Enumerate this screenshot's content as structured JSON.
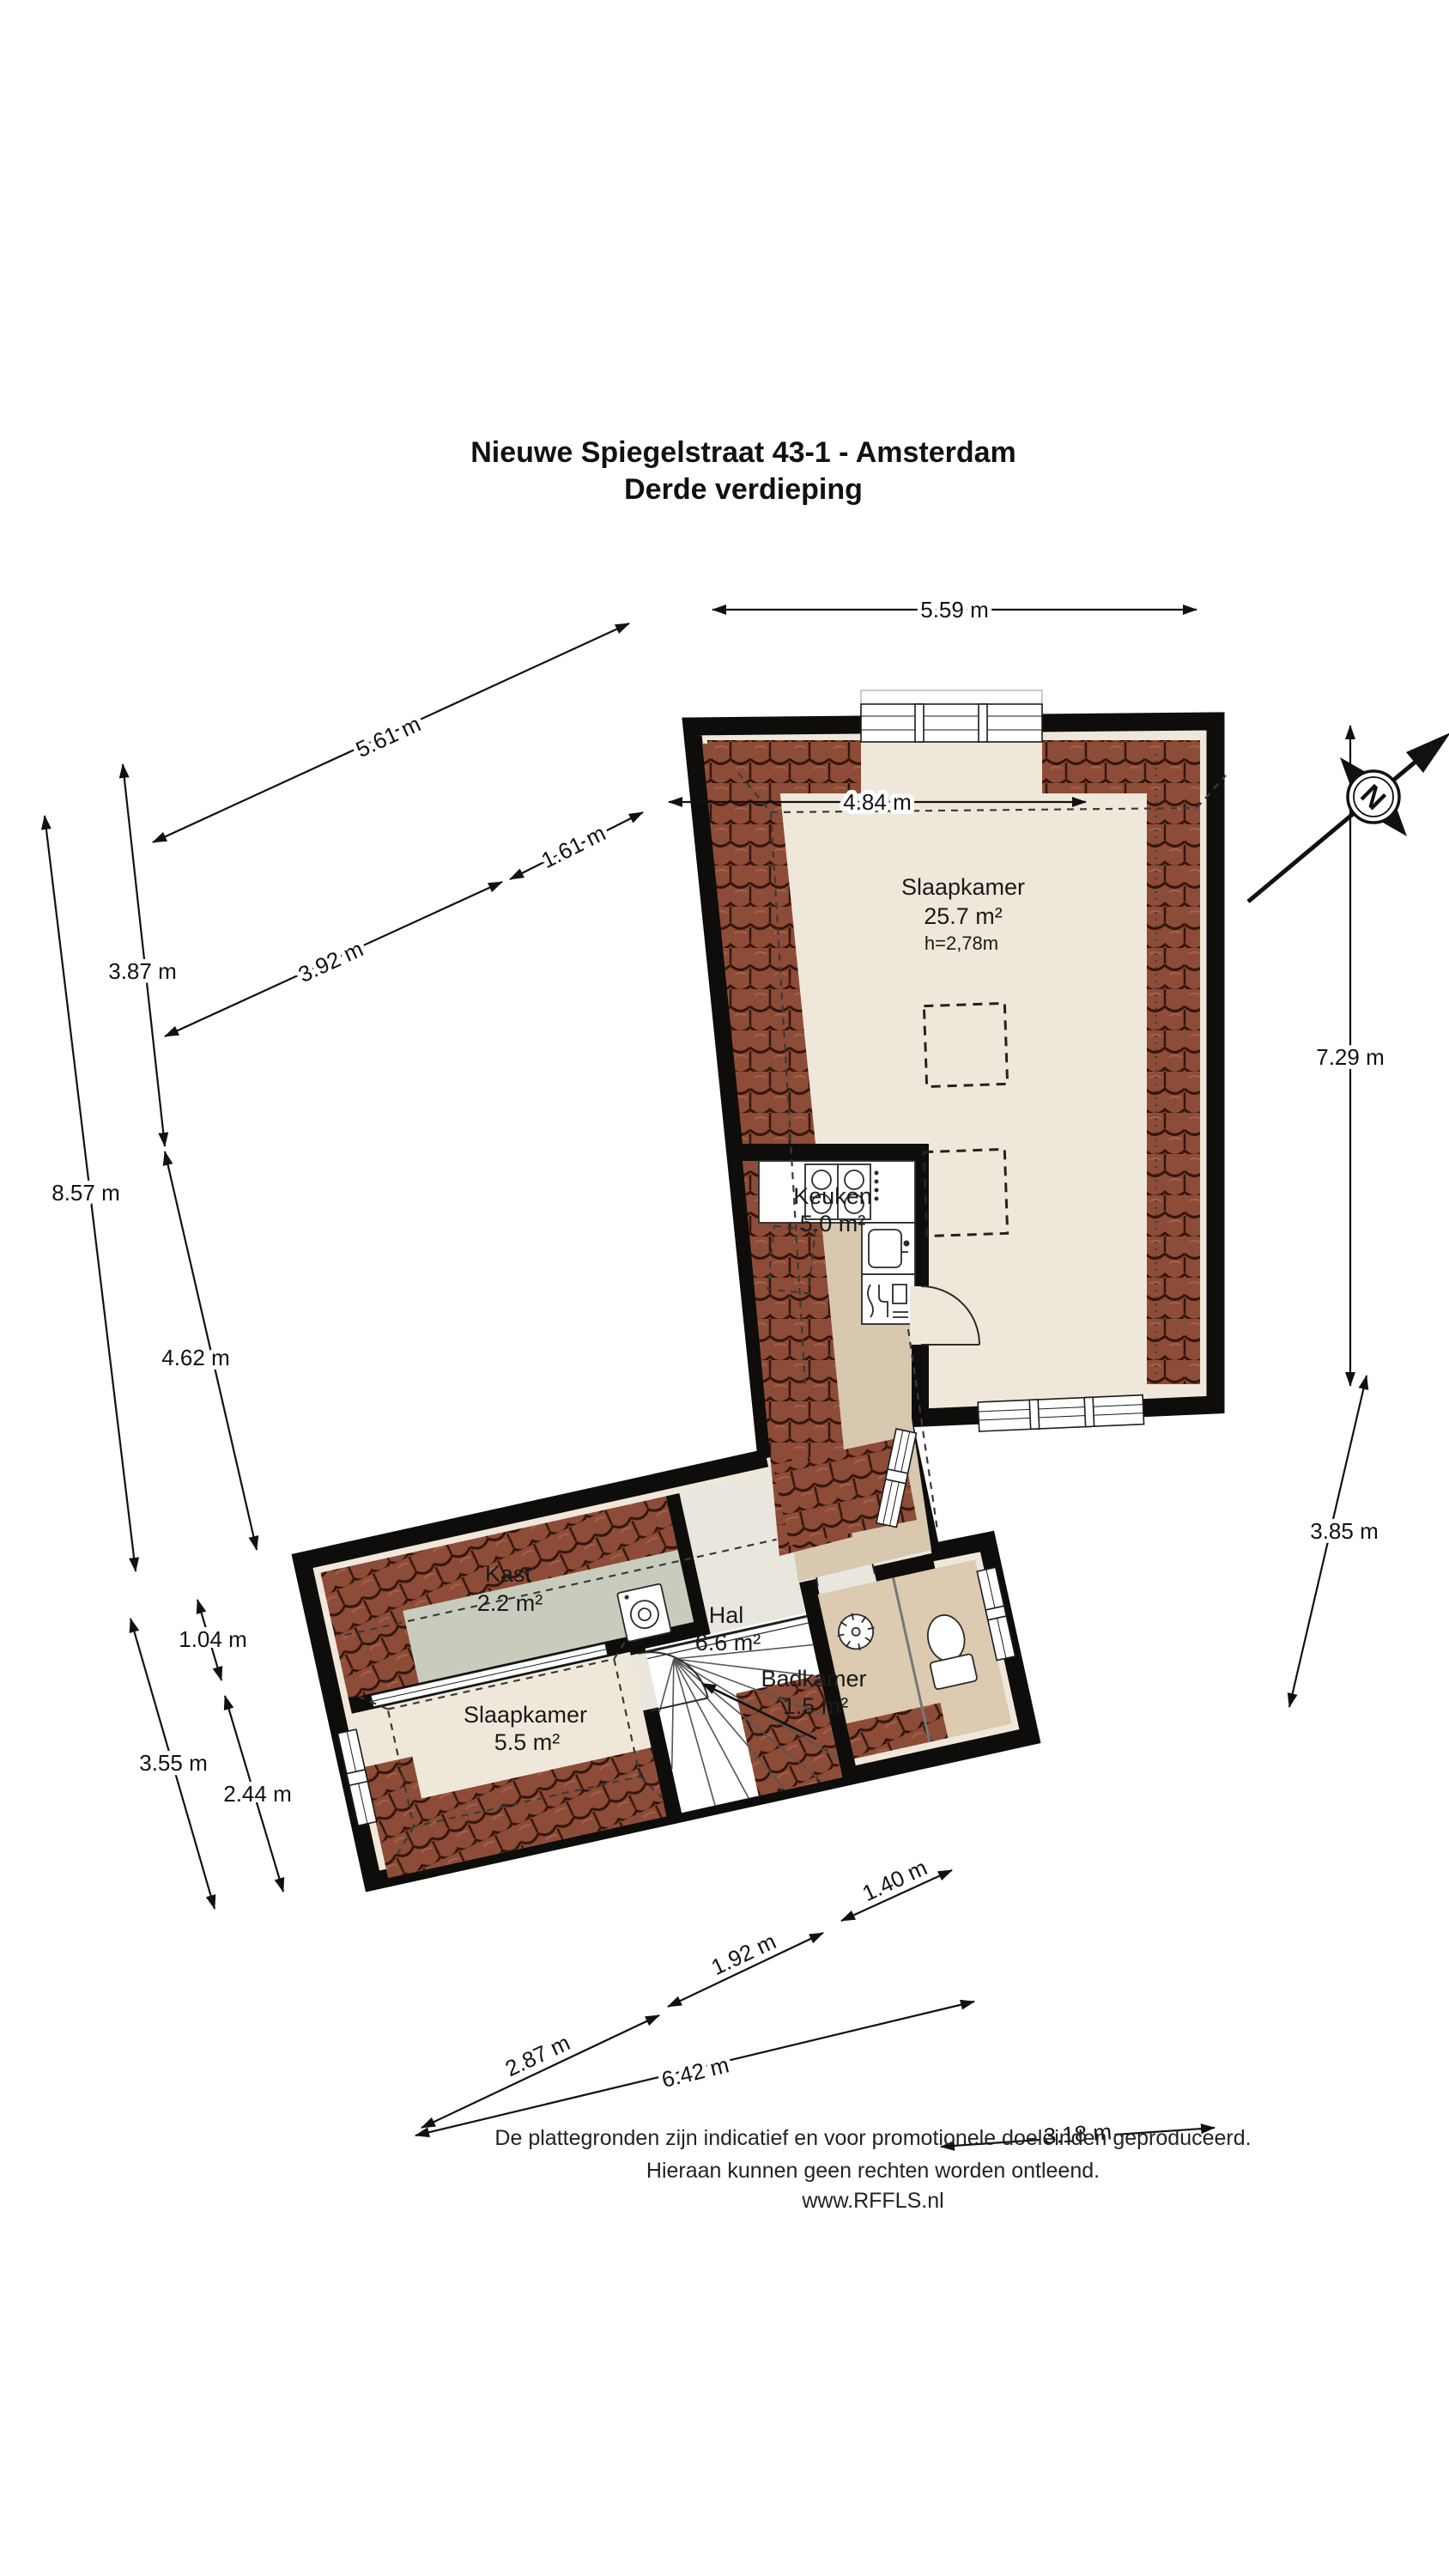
{
  "title": {
    "line1": "Nieuwe Spiegelstraat 43-1 - Amsterdam",
    "line2": "Derde verdieping"
  },
  "rooms": {
    "slaapkamer_main": {
      "name": "Slaapkamer",
      "area": "25.7 m²",
      "height": "h=2,78m"
    },
    "keuken": {
      "name": "Keuken",
      "area": "5.0 m²"
    },
    "kast": {
      "name": "Kast",
      "area": "2.2 m²"
    },
    "hal": {
      "name": "Hal",
      "area": "6.6 m²"
    },
    "slaapkamer_small": {
      "name": "Slaapkamer",
      "area": "5.5 m²"
    },
    "badkamer": {
      "name": "Badkamer",
      "area": "1.5 m²"
    }
  },
  "dimensions": {
    "top": [
      "5.59 m",
      "4.84 m"
    ],
    "top_left": [
      "5.61 m",
      "1.61 m",
      "3.92 m"
    ],
    "left": [
      "3.87 m",
      "8.57 m",
      "4.62 m"
    ],
    "left_lower": [
      "1.04 m",
      "3.55 m",
      "2.44 m"
    ],
    "right": [
      "7.29 m",
      "3.85 m"
    ],
    "bottom": [
      "1.40 m",
      "1.92 m",
      "2.87 m",
      "6.42 m",
      "3.18 m"
    ]
  },
  "compass": {
    "north": "N"
  },
  "footer": {
    "line1": "De plattegronden zijn indicatief en voor promotionele doeleinden geproduceerd.",
    "line2": "Hieraan kunnen geen rechten worden ontleend.",
    "line3": "www.RFFLS.nl"
  },
  "colors": {
    "floor_cream": "#efe8da",
    "floor_tan": "#d8c8af",
    "floor_hal": "#e9e6dd",
    "floor_kast": "#c8ccbc",
    "floor_bad": "#dccbb1",
    "wall": "#0e0d0b",
    "tile": "#8d4c37"
  }
}
